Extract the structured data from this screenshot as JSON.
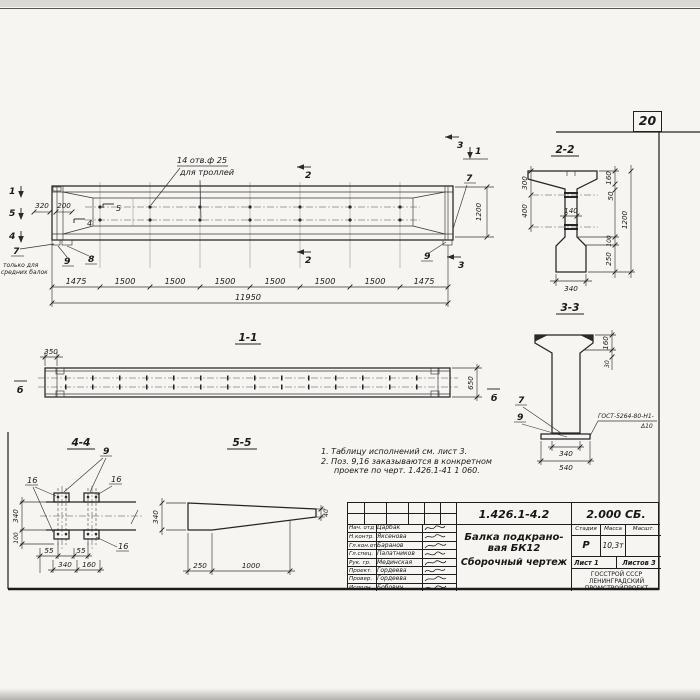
{
  "sheet_badge": "20",
  "elevation": {
    "marker_1": "1",
    "marker_5": "5",
    "marker_4": "4",
    "marker_2": "2",
    "marker_3": "3",
    "flag_5": "5",
    "flag_4": "4",
    "holes_note_line1": "14 отв.ф 25",
    "holes_note_line2": "для троллей",
    "dim_320": "320",
    "dim_200": "200",
    "dim_1200": "1200",
    "dim_overall": "11950",
    "segment_dims": [
      "1475",
      "1500",
      "1500",
      "1500",
      "1500",
      "1500",
      "1500",
      "1475"
    ],
    "callout_7": "7",
    "callout_8": "8",
    "callout_9": "9",
    "left_note_line1": "только для",
    "left_note_line2": "средних балок"
  },
  "section_2_2": {
    "title": "2-2",
    "dim_300": "300",
    "dim_400": "400",
    "dim_140": "140",
    "dim_160": "160",
    "dim_50": "50",
    "dim_1200": "1200",
    "dim_100": "100",
    "dim_250": "250",
    "dim_340": "340"
  },
  "section_3_3": {
    "title": "3-3",
    "dim_160": "160",
    "dim_30": "30",
    "callout_7": "7",
    "callout_9": "9",
    "weld_spec_line1": "ГОСТ-5264-80-Н1-",
    "weld_spec_line2": "Δ10",
    "dim_340": "340",
    "dim_540": "540"
  },
  "section_1_1": {
    "title": "1-1",
    "dim_350": "350",
    "dim_650": "650",
    "marker_b": "б"
  },
  "section_4_4": {
    "title": "4-4",
    "callout_9": "9",
    "callout_16": "16",
    "dim_340": "340",
    "dim_100": "100",
    "dim_55": "55",
    "dim_340b": "340",
    "dim_160": "160"
  },
  "section_5_5": {
    "title": "5-5",
    "dim_340": "340",
    "dim_40": "40",
    "dim_250": "250",
    "dim_1000": "1000"
  },
  "notes": {
    "line1": "1. Таблицу исполнений см. лист 3.",
    "line2": "2. Поз. 9,16 заказываются в конкретном",
    "line3": "проекте по черт. 1.426.1-41 1 060."
  },
  "stamp": {
    "doc_number": "1.426.1-4.2",
    "series": "2.000 СБ.",
    "product_title_line1": "Балка подкрано-",
    "product_title_line2": "вая БК12",
    "product_title_line3": "Сборочный чертеж",
    "col_stage": "Стадия",
    "col_mass": "Масса",
    "col_scale": "Масшт.",
    "stage_value": "Р",
    "mass_value": "10,3т",
    "sheet_label": "Лист 1",
    "sheets_label": "Листов 3",
    "org_line1": "ГОССТРОЙ СССР",
    "org_line2": "ЛЕНИНГРАДСКИЙ",
    "org_line3": "ПРОМСТРОЙПРОЕКТ",
    "rows": [
      {
        "role": "Нач. отд",
        "name": "Царбак"
      },
      {
        "role": "Н.контр.",
        "name": "Яксенова"
      },
      {
        "role": "Гл.кон.от",
        "name": "Баранов"
      },
      {
        "role": "Гл.спец.",
        "name": "Палатников"
      },
      {
        "role": "Рук. гр.",
        "name": "Мединская"
      },
      {
        "role": "Проект.",
        "name": "Гордеева"
      },
      {
        "role": "Провер.",
        "name": "Гордеева"
      },
      {
        "role": "Исполн.",
        "name": "Бобович"
      }
    ]
  }
}
